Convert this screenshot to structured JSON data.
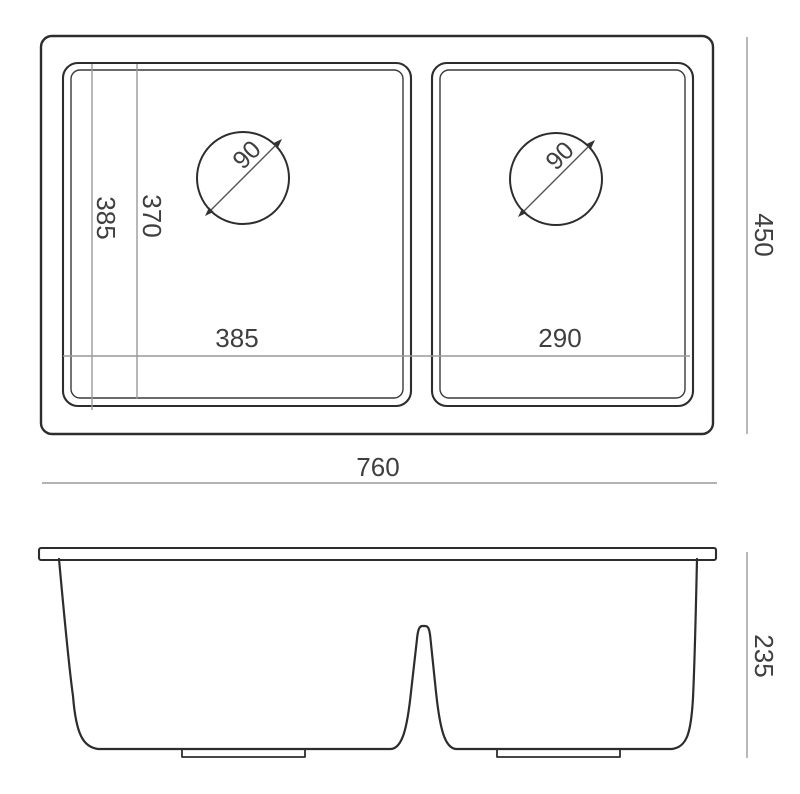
{
  "drawing": {
    "type": "technical-drawing",
    "subject": "double-bowl sink dimension drawing",
    "colors": {
      "background": "#ffffff",
      "outline": "#2d2d2d",
      "dimension_line": "#9a9a9a",
      "label_text": "#3f3f3f"
    },
    "top_view": {
      "labels": {
        "left_bowl_depth": "385",
        "left_bowl_inner_depth": "370",
        "left_bowl_width": "385",
        "right_bowl_width": "290",
        "overall_width": "760",
        "overall_depth": "450",
        "left_drain_diameter": "90",
        "right_drain_diameter": "90"
      }
    },
    "side_view": {
      "labels": {
        "overall_height": "235"
      }
    }
  }
}
